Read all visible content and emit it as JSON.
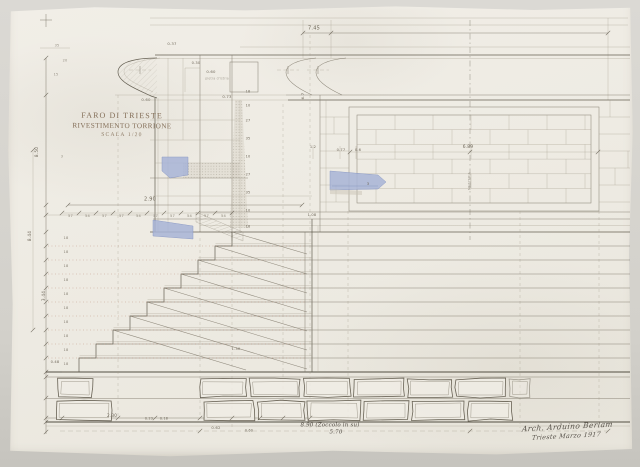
{
  "title_block": {
    "line1": "FARO DI TRIESTE",
    "line2": "RIVESTIMENTO TORRIONE",
    "line3": "SCALA 1/20"
  },
  "signature": {
    "line1": "Arch. Arduino Berlam",
    "line2": "Trieste Marzo 1917"
  },
  "annotations": [
    {
      "t": "7.45",
      "x": 314,
      "y": 29,
      "s": 5
    },
    {
      "t": "2.90",
      "x": 150,
      "y": 200,
      "s": 5
    },
    {
      "t": "0.37",
      "x": 172,
      "y": 44,
      "s": 3.8
    },
    {
      "t": "0.30",
      "x": 196,
      "y": 64,
      "s": 3.6
    },
    {
      "t": "0.60",
      "x": 211,
      "y": 72,
      "s": 3.8
    },
    {
      "t": "pietra d'istria",
      "x": 217,
      "y": 79,
      "s": 3.1,
      "o": 0.55
    },
    {
      "t": "0.73",
      "x": 227,
      "y": 97,
      "s": 3.8
    },
    {
      "t": "0.60",
      "x": 146,
      "y": 100,
      "s": 3.8
    },
    {
      "t": "6.7",
      "x": 303,
      "y": 96,
      "r": -90,
      "s": 3.8
    },
    {
      "t": "35",
      "x": 57,
      "y": 46,
      "s": 3.5,
      "o": 0.7
    },
    {
      "t": "20",
      "x": 65,
      "y": 61,
      "s": 3.5,
      "o": 0.7
    },
    {
      "t": "15",
      "x": 56,
      "y": 75,
      "s": 3.5,
      "o": 0.7
    },
    {
      "t": "3",
      "x": 62,
      "y": 157,
      "s": 3.5,
      "o": 0.7
    },
    {
      "t": "8.50",
      "x": 37,
      "y": 152,
      "r": -90,
      "s": 4.2
    },
    {
      "t": "8.44",
      "x": 30,
      "y": 236,
      "r": -90,
      "s": 4.2
    },
    {
      "t": "3.44",
      "x": 44,
      "y": 296,
      "r": -90,
      "s": 4.2
    },
    {
      "t": "0.48",
      "x": 55,
      "y": 363,
      "s": 3.6
    },
    {
      "t": "18",
      "x": 248,
      "y": 92,
      "s": 3.5
    },
    {
      "t": "10",
      "x": 248,
      "y": 106,
      "s": 3.5
    },
    {
      "t": "27",
      "x": 248,
      "y": 121,
      "s": 3.5
    },
    {
      "t": "35",
      "x": 248,
      "y": 139,
      "s": 3.5
    },
    {
      "t": "10",
      "x": 248,
      "y": 157,
      "s": 3.5
    },
    {
      "t": "27",
      "x": 248,
      "y": 175,
      "s": 3.5
    },
    {
      "t": "35",
      "x": 248,
      "y": 193,
      "s": 3.5
    },
    {
      "t": "10",
      "x": 248,
      "y": 211,
      "s": 3.5
    },
    {
      "t": "18",
      "x": 248,
      "y": 227,
      "s": 3.5
    },
    {
      "t": "1.2",
      "x": 313,
      "y": 148,
      "s": 3.6
    },
    {
      "t": "0.77",
      "x": 341,
      "y": 151,
      "s": 3.6
    },
    {
      "t": "0.6",
      "x": 358,
      "y": 151,
      "s": 3.6
    },
    {
      "t": "6.89",
      "x": 468,
      "y": 148,
      "s": 4.4
    },
    {
      "t": "3",
      "x": 368,
      "y": 184,
      "s": 3.8
    },
    {
      "t": "1.08",
      "x": 312,
      "y": 216,
      "s": 3.6
    },
    {
      "t": "1.30",
      "x": 236,
      "y": 350,
      "s": 3.6
    },
    {
      "t": "2.30",
      "x": 112,
      "y": 416,
      "s": 4.2
    },
    {
      "t": "0.23",
      "x": 149,
      "y": 419,
      "s": 3.3
    },
    {
      "t": "0.18",
      "x": 164,
      "y": 419,
      "s": 3.3
    },
    {
      "t": "0.62",
      "x": 216,
      "y": 428,
      "s": 3.8
    },
    {
      "t": "0.60",
      "x": 249,
      "y": 431,
      "s": 3.3
    },
    {
      "t": "MEZZERIA",
      "x": 470,
      "y": 181,
      "r": -90,
      "s": 3.2,
      "o": 0.6
    },
    {
      "t": "8.90 (Zoccolo in su)",
      "x": 330,
      "y": 426,
      "s": 5.5,
      "h": 1
    },
    {
      "t": "5.70",
      "x": 336,
      "y": 433,
      "s": 5.5,
      "h": 1
    }
  ],
  "tread_labels": [
    "57",
    "54",
    "57",
    "57",
    "54",
    "57",
    "57",
    "54",
    "57",
    "54"
  ],
  "riser_labels": [
    "18",
    "18",
    "18",
    "18",
    "18",
    "18",
    "18",
    "18",
    "18",
    "18"
  ],
  "colors": {
    "paper": "#efece4",
    "backdrop": "#d3d1cb",
    "ink": "#6e6759",
    "dark_ink": "#4a4639",
    "blue_wash": "#a8b4d7",
    "red_guide": "#b5826d",
    "stipple": "#c9c4b5"
  }
}
